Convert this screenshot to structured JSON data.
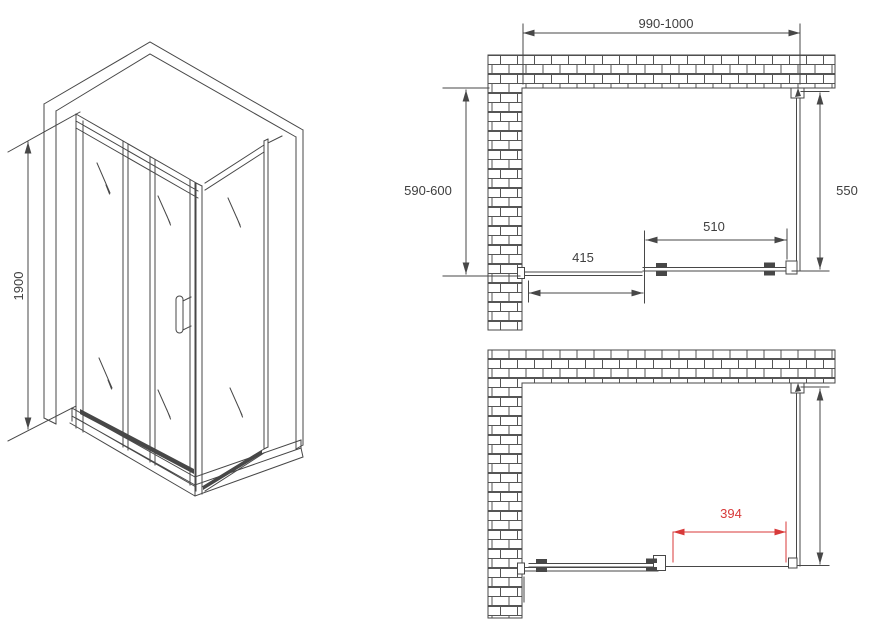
{
  "page": {
    "background": "#ffffff"
  },
  "drawing": {
    "line_color": "#474747",
    "dim_text_color": "#3f3f3f",
    "accent_red": "#d83a3a",
    "wall_hatch_color": "#555555"
  },
  "isometric_view": {
    "height_label": "1900"
  },
  "plan_view_top": {
    "width_label": "990-1000",
    "depth_label": "590-600",
    "side_panel_label": "550",
    "door_label": "510",
    "fixed_panel_label": "415"
  },
  "plan_view_bottom": {
    "opening_label": "394"
  }
}
